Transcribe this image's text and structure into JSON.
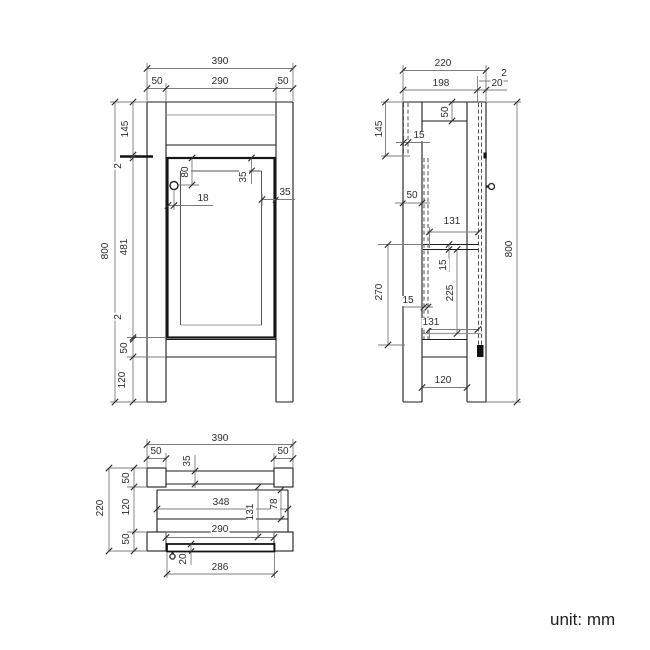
{
  "drawing": {
    "unit_note": "unit: mm",
    "colors": {
      "background": "#ffffff",
      "object_line": "#1c1c1c",
      "secondary_line": "#9b9b9b",
      "dimension_line": "#7c7c7c",
      "text": "#2d2d2d"
    },
    "front_view": {
      "dim_labels": [
        "390",
        "50",
        "290",
        "50",
        "800",
        "145",
        "2",
        "481",
        "2",
        "50",
        "120",
        "80",
        "18",
        "35",
        "35"
      ]
    },
    "side_view": {
      "dim_labels": [
        "220",
        "198",
        "2",
        "20",
        "145",
        "50",
        "15",
        "50",
        "131",
        "15",
        "225",
        "131",
        "270",
        "15",
        "800",
        "120"
      ]
    },
    "bottom_view": {
      "dim_labels": [
        "390",
        "50",
        "50",
        "35",
        "220",
        "50",
        "120",
        "50",
        "348",
        "78",
        "131",
        "290",
        "20",
        "286"
      ]
    }
  }
}
